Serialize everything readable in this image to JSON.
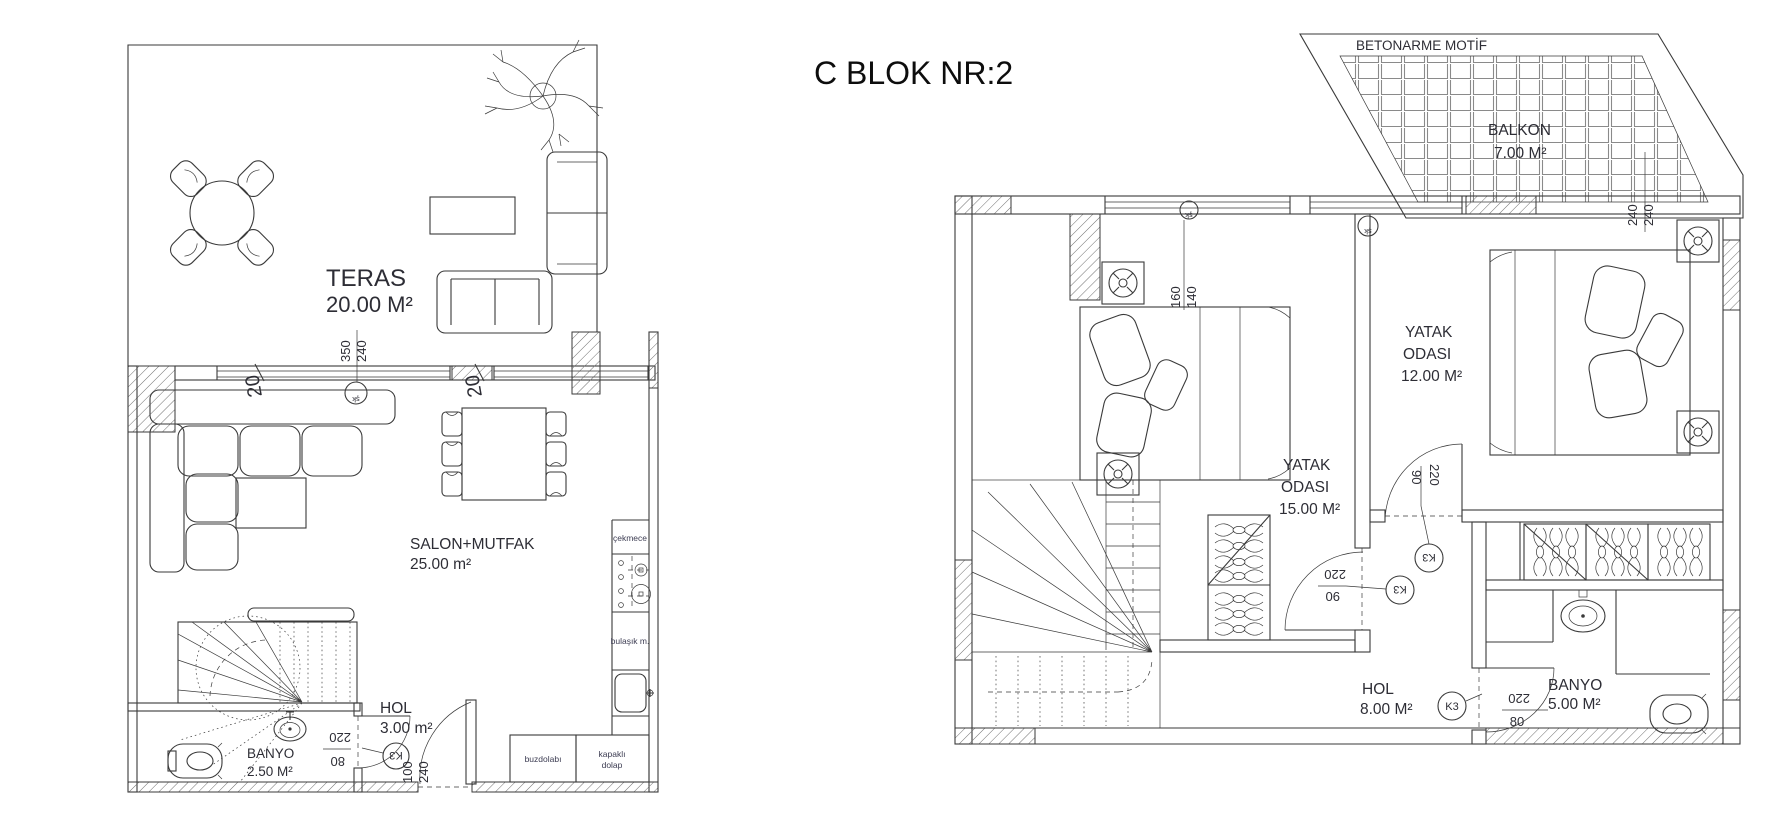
{
  "title": "C BLOK NR:2",
  "lower": {
    "teras_name": "TERAS",
    "teras_area": "20.00 M²",
    "salon_name": "SALON+MUTFAK",
    "salon_area": "25.00 m²",
    "hol_name": "HOL",
    "hol_area": "3.00 m²",
    "banyo_name": "BANYO",
    "banyo_area": "2.50 M²",
    "cekmece": "çekmece",
    "bulasik": "bulaşık m.",
    "buzdolabi": "buzdolabı",
    "kapakli_line1": "kapaklı",
    "kapakli_line2": "dolap",
    "dim_sill": "20",
    "dim_win_w": "350",
    "dim_win_h": "240",
    "dim_wc_door_w": "220",
    "dim_wc_door_h": "80",
    "dim_entry_w": "100",
    "dim_entry_h": "240",
    "door_code": "K3",
    "win_code": "şk"
  },
  "upper": {
    "motif": "BETONARME MOTİF",
    "balkon_name": "BALKON",
    "balkon_area": "7.00 M²",
    "yatak1_line1": "YATAK",
    "yatak1_line2": "ODASI",
    "yatak1_area": "15.00 M²",
    "yatak2_line1": "YATAK",
    "yatak2_line2": "ODASI",
    "yatak2_area": "12.00 M²",
    "hol_name": "HOL",
    "hol_area": "8.00 M²",
    "banyo_name": "BANYO",
    "banyo_area": "5.00 M²",
    "dim_balkon": "240",
    "dim_win_w": "160",
    "dim_win_h": "140",
    "dim_door_w": "220",
    "dim_door_h": "90",
    "dim_bath_w": "220",
    "dim_bath_h": "80",
    "door_code": "K3",
    "win_code": "şk"
  }
}
